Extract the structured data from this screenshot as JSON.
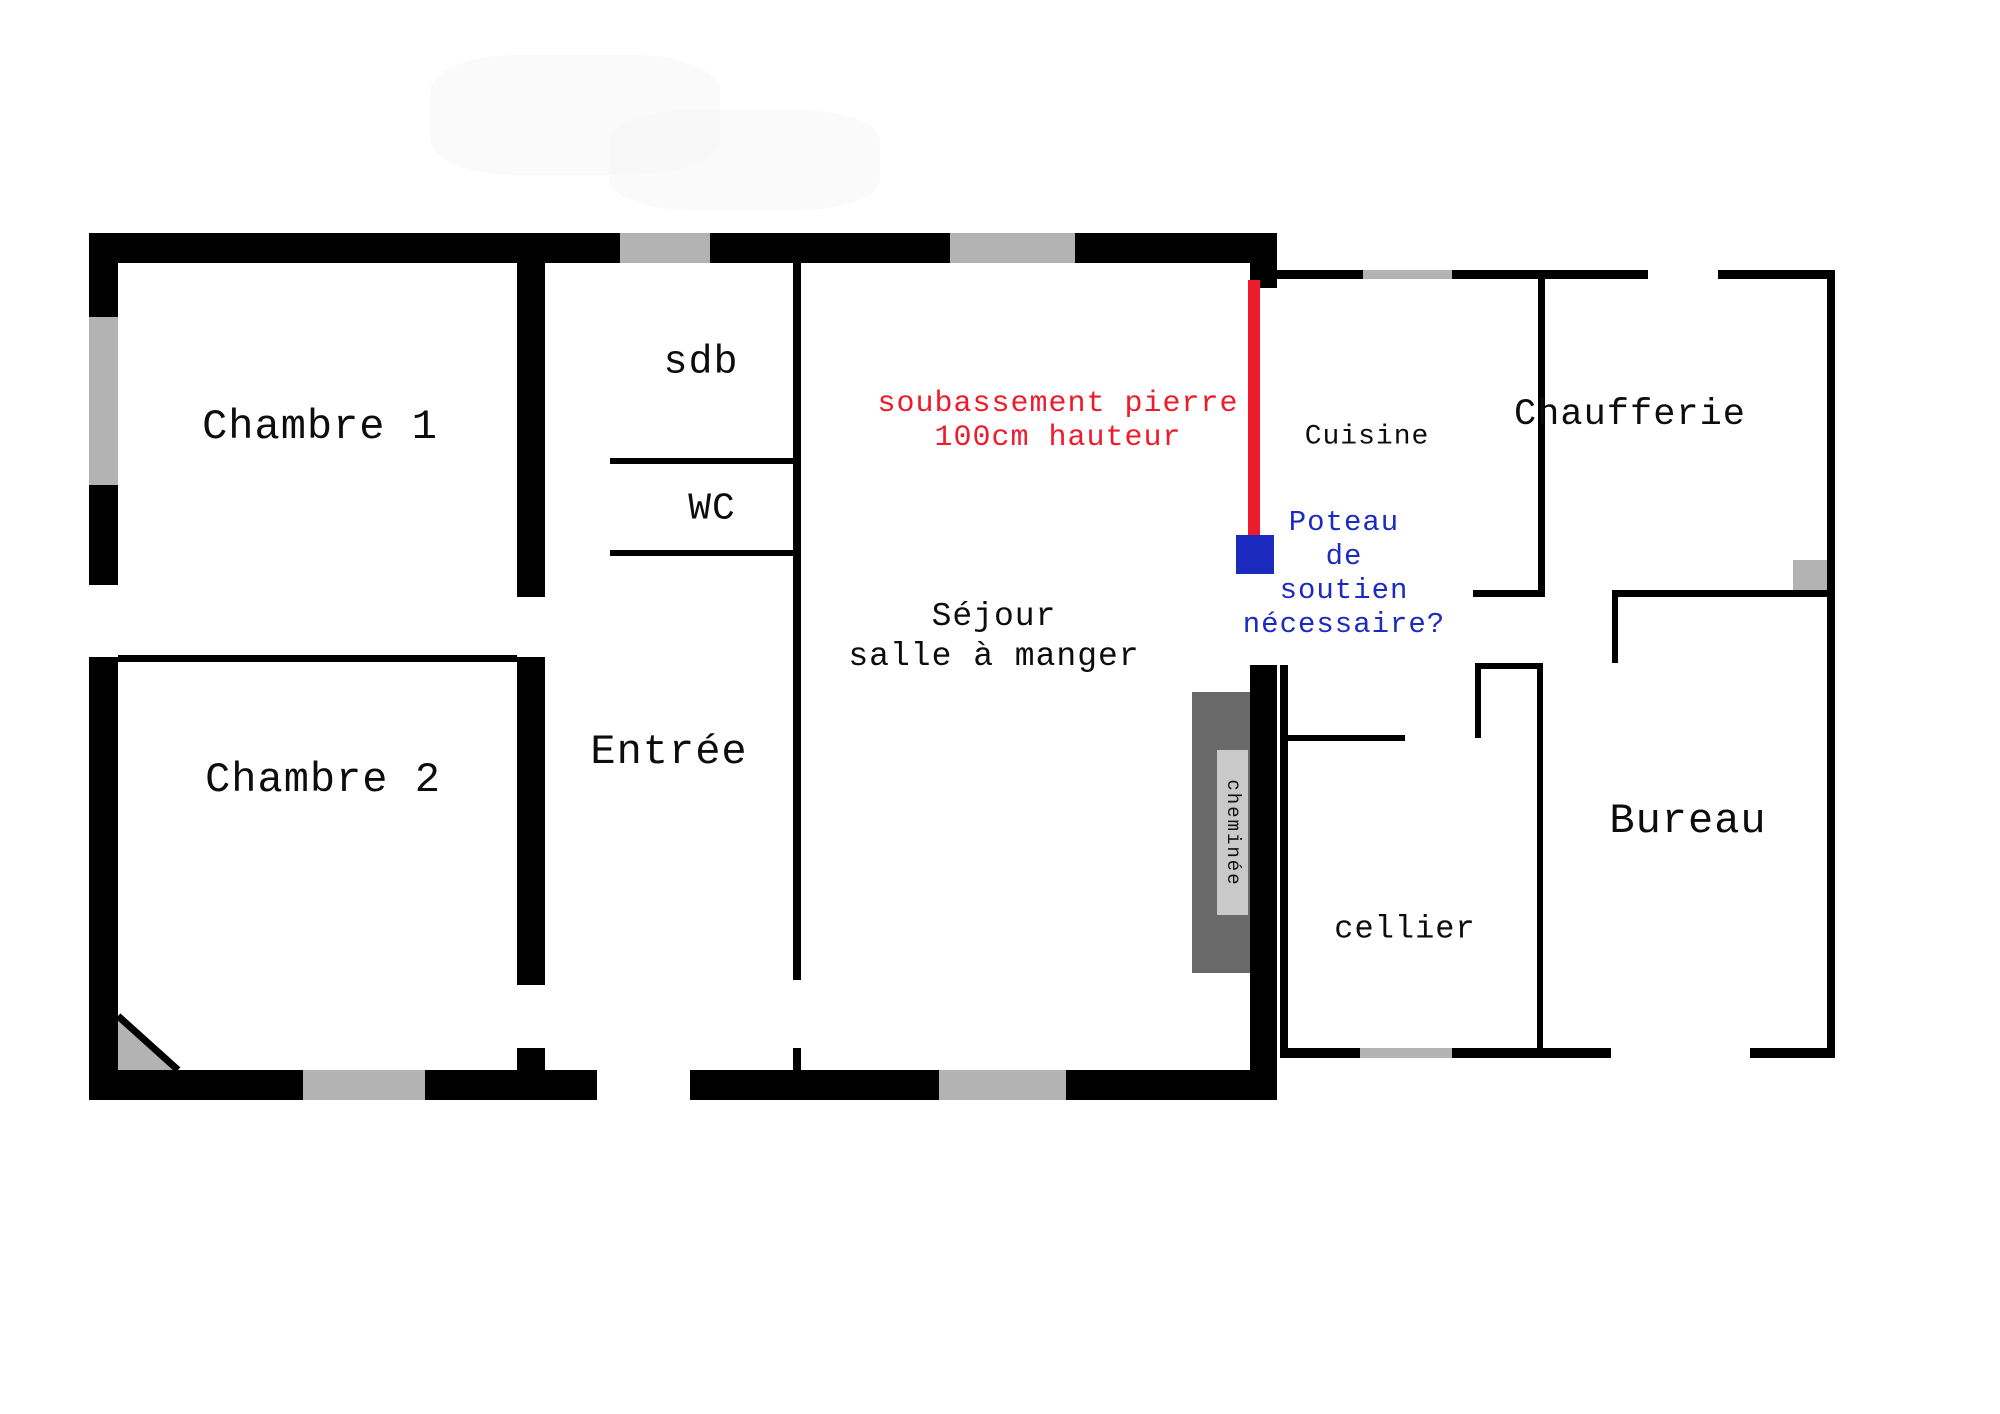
{
  "rooms": {
    "chambre1": "Chambre 1",
    "chambre2": "Chambre 2",
    "sdb": "sdb",
    "wc": "WC",
    "entree": "Entrée",
    "sejour_line1": "Séjour",
    "sejour_line2": "salle à manger",
    "cuisine": "Cuisine",
    "chaufferie": "Chaufferie",
    "bureau": "Bureau",
    "cellier": "cellier",
    "cheminee": "cheminée"
  },
  "annotations": {
    "stone_base_line1": "soubassement pierre",
    "stone_base_line2": "100cm hauteur",
    "support": [
      "Poteau",
      "de",
      "soutien",
      "nécessaire?"
    ]
  },
  "colors": {
    "wall": "#000000",
    "window": "#b3b3b3",
    "chimney": "#696969",
    "chimney_label_bg": "#c9c9c9",
    "annotation_red": "#ee1b2d",
    "annotation_blue": "#1c2bbf"
  }
}
